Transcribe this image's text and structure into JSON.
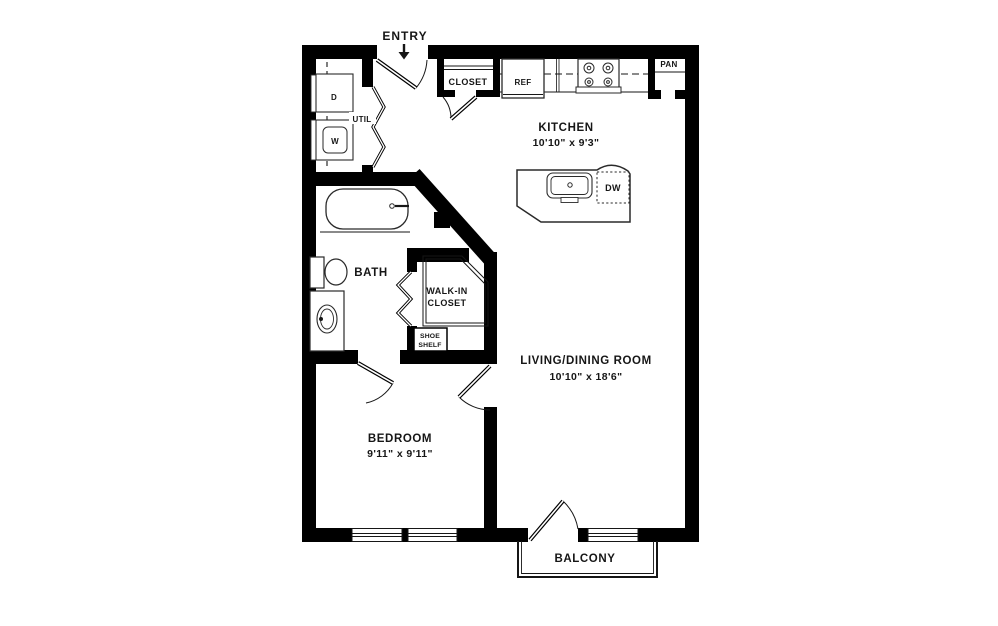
{
  "colors": {
    "background": "#ffffff",
    "walls": "#000000",
    "lines": "#161616",
    "text": "#161616"
  },
  "entry": {
    "label": "ENTRY"
  },
  "rooms": {
    "kitchen": {
      "name": "KITCHEN",
      "dims": "10'10\" x 9'3\""
    },
    "living_dining": {
      "name": "LIVING/DINING ROOM",
      "dims": "10'10\" x 18'6\""
    },
    "bedroom": {
      "name": "BEDROOM",
      "dims": "9'11\" x 9'11\""
    },
    "bath": {
      "name": "BATH"
    },
    "walk_in_closet": {
      "line1": "WALK-IN",
      "line2": "CLOSET"
    },
    "balcony": {
      "name": "BALCONY"
    },
    "utility": {
      "name": "UTIL"
    },
    "entry_closet": {
      "name": "CLOSET"
    }
  },
  "appliances": {
    "refrigerator": "REF",
    "pantry": "PAN",
    "dishwasher": "DW",
    "dryer": "D",
    "washer": "W",
    "shoe_shelf": {
      "line1": "SHOE",
      "line2": "SHELF"
    }
  }
}
